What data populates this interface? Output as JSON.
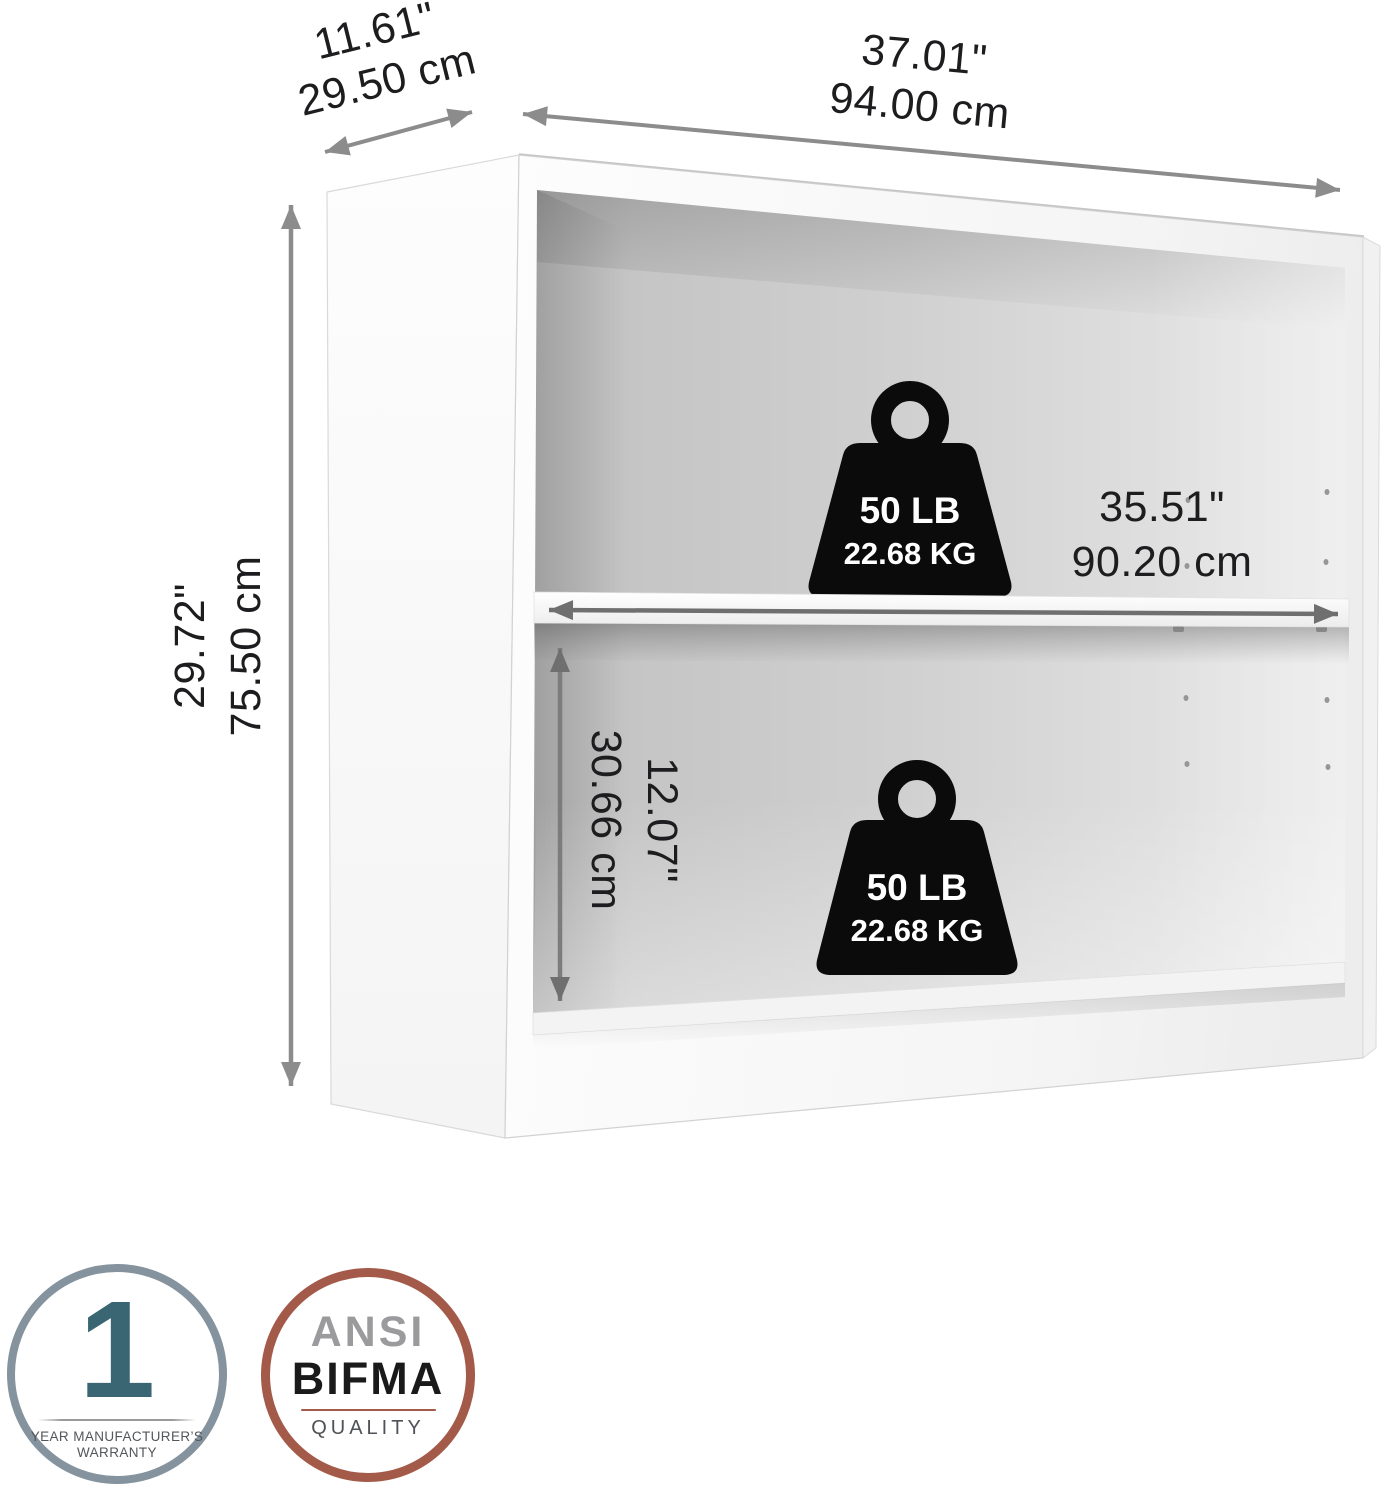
{
  "dimensions": {
    "depth": {
      "in": "11.61\"",
      "cm": "29.50 cm"
    },
    "width": {
      "in": "37.01\"",
      "cm": "94.00 cm"
    },
    "height": {
      "in": "29.72\"",
      "cm": "75.50 cm"
    },
    "shelf": {
      "in": "35.51\"",
      "cm": "90.20 cm"
    },
    "opening": {
      "in": "12.07\"",
      "cm": "30.66 cm"
    }
  },
  "capacity": {
    "upper": {
      "lb": "50 LB",
      "kg": "22.68 KG"
    },
    "lower": {
      "lb": "50 LB",
      "kg": "22.68 KG"
    }
  },
  "badges": {
    "warranty": {
      "value": "1",
      "caption_line1": "YEAR MANUFACTURER’S",
      "caption_line2": "WARRANTY"
    },
    "ansi_bifma": {
      "line1": "ANSI",
      "line2": "BIFMA",
      "caption": "QUALITY"
    }
  },
  "colors": {
    "arrow": "#8c8c8c",
    "arrow_dark": "#6f6f6f",
    "label_text": "#1d1d1f",
    "weight_fill": "#0b0b0b",
    "weight_text": "#ffffff",
    "badge_warranty_ring": "#84939e",
    "badge_warranty_number": "#3a6573",
    "badge_caption_text": "#53565a",
    "badge_bifma_ring": "#a45a48",
    "badge_ansi_text": "#9b9b9d",
    "badge_bifma_text": "#1a1a1a"
  }
}
